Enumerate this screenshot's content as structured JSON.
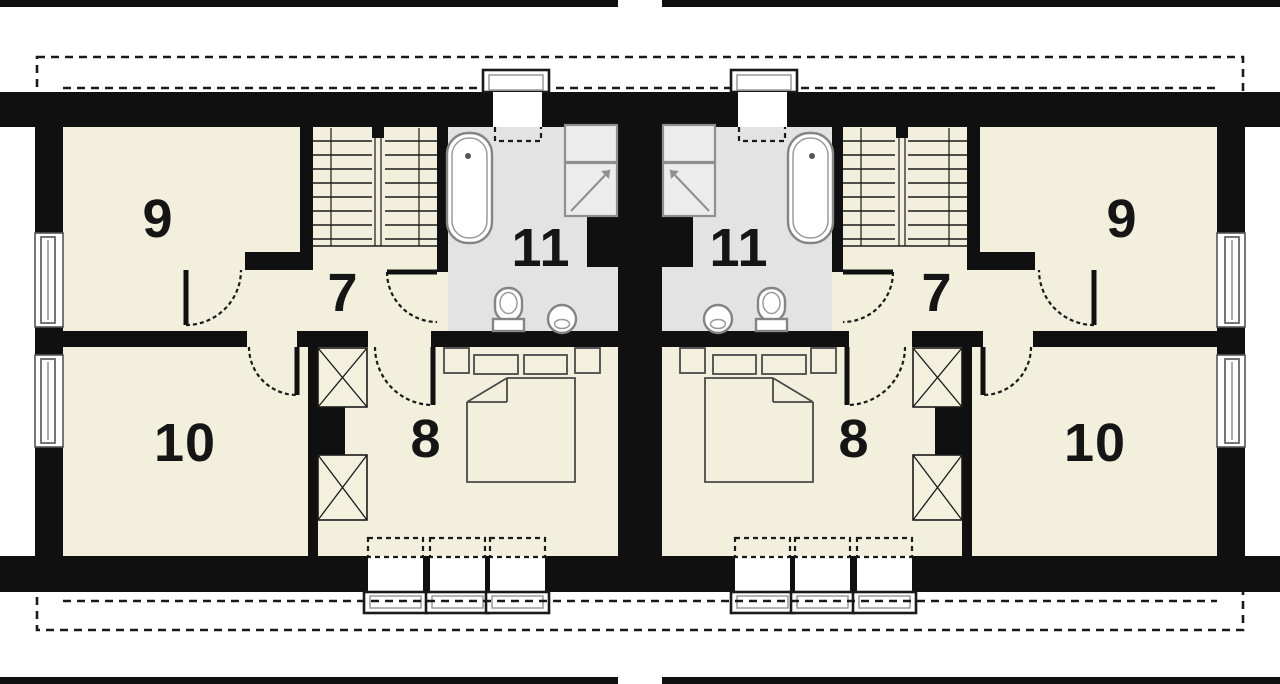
{
  "plan": {
    "colors": {
      "wall": "#101010",
      "floor": "#f2efdc",
      "bathroom_floor": "#e3e3e3",
      "fixture_outline": "#858585",
      "background": "#ffffff"
    },
    "units": [
      {
        "side": "left",
        "room_labels": {
          "r9": "9",
          "r7": "7",
          "r11": "11",
          "r8": "8",
          "r10": "10"
        },
        "fixtures": [
          "staircase",
          "bathtub",
          "shower-cabin",
          "bathroom-cabinet",
          "toilet",
          "washbasin",
          "double-bed",
          "nightstands",
          "pillows",
          "duvet",
          "wardrobes",
          "roof-window",
          "facade-windows"
        ]
      },
      {
        "side": "right",
        "room_labels": {
          "r9": "9",
          "r7": "7",
          "r11": "11",
          "r8": "8",
          "r10": "10"
        },
        "fixtures": [
          "staircase",
          "bathtub",
          "shower-cabin",
          "bathroom-cabinet",
          "toilet",
          "washbasin",
          "double-bed",
          "nightstands",
          "pillows",
          "duvet",
          "wardrobes",
          "roof-window",
          "facade-windows"
        ]
      }
    ]
  }
}
